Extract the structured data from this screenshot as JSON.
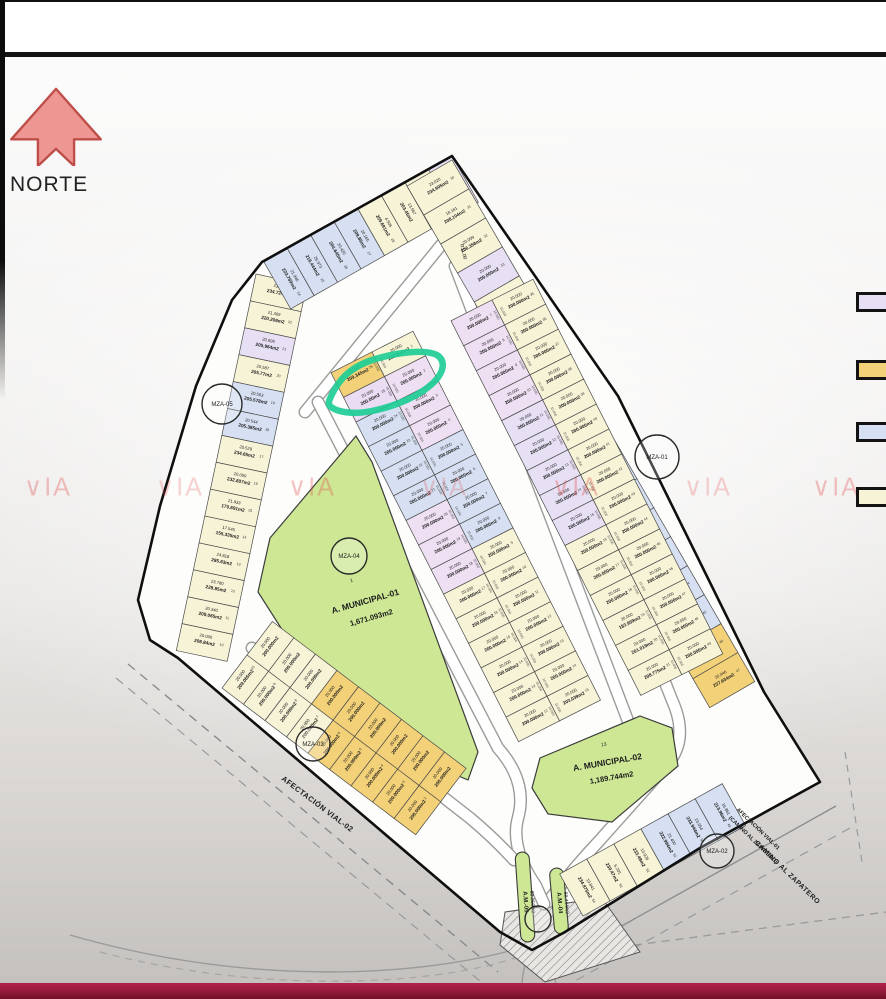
{
  "north": {
    "label": "NORTE"
  },
  "watermark": {
    "text": "VIA",
    "color": "#de4a4a"
  },
  "legend": {
    "items": [
      {
        "name": "lavender-lot",
        "color": "#e7dff3"
      },
      {
        "name": "gold-lot",
        "color": "#f3d178"
      },
      {
        "name": "blue-lot",
        "color": "#d6e0f2"
      },
      {
        "name": "cream-lot",
        "color": "#f6f3d6"
      }
    ]
  },
  "highlight": {
    "lot_number": "25",
    "area_label": "200.00m2",
    "color": "#1ecd96"
  },
  "palette": {
    "C": "#f6f3d6",
    "B": "#d6e0f2",
    "L": "#e7dff3",
    "P": "#eedff2",
    "O": "#f3d178",
    "H": "#eadcf2",
    "G": "#cde795"
  },
  "municipal": [
    {
      "num": "1",
      "name": "A. MUNICIPAL-01",
      "area": "1,671.093m2"
    },
    {
      "num": "13",
      "name": "A. MUNICIPAL-02",
      "area": "1,189.744m2"
    }
  ],
  "green_strips": [
    {
      "name": "A.M.-05",
      "area": "80.058m2"
    },
    {
      "name": "A.M.-04",
      "area": "60.444m2"
    }
  ],
  "mza_circles": [
    "MZA-01",
    "MZA-02",
    "MZA-03",
    "MZA-04",
    "MZA-05"
  ],
  "roads": {
    "vial02": "AFECTACIÓN VIAL-02",
    "vial01_line1": "AFECTACIÓN VIAL-01",
    "vial01_line2": "(CAMINO AL ZAPATERO)",
    "camino": "CAMINO AL ZAPATERO",
    "radius": "R11.00"
  },
  "strips": {
    "leftPerimeter": {
      "labels": [
        "234.724m2",
        "220.208m2",
        "205.964m2",
        "205.77m2",
        "205.578m2",
        "205.385m2",
        "234.65m2",
        "232.607m2",
        "170.691m2",
        "155.335m2",
        "285.63m2",
        "228.85m2",
        "209.065m2",
        "208.84m2"
      ],
      "dims": [
        "21.306",
        "21.309",
        "20.006",
        "20.587",
        "20.563",
        "20.544",
        "20.529",
        "20.000",
        "21.933",
        "17.545",
        "24.818",
        "23.780",
        "20.340",
        "20.000"
      ],
      "colors": [
        "C",
        "C",
        "L",
        "C",
        "B",
        "B",
        "C",
        "C",
        "C",
        "C",
        "C",
        "C",
        "C",
        "C"
      ],
      "numbers": [
        "23",
        "22",
        "21",
        "20",
        "19",
        "18",
        "17",
        "16",
        "15",
        "14",
        "13",
        "12",
        "11",
        "10"
      ]
    },
    "topPerimeter": {
      "labels": [
        "223.769m2",
        "216.444m2",
        "204.645m2",
        "209.85m2",
        "209.691m2",
        "203.45m2",
        "221.298m2",
        "208.35m2"
      ],
      "dims": [
        "21.946",
        "26.973",
        "20.420",
        "20.165",
        "4.506",
        "13.567",
        "27.033",
        "18.450"
      ],
      "colors": [
        "B",
        "B",
        "B",
        "B",
        "C",
        "C",
        "C",
        "L"
      ],
      "numbers": [
        "24",
        "25",
        "26",
        "27",
        "28",
        "",
        "",
        "29"
      ]
    },
    "rightPerimeter": {
      "labels": [
        "234.905m2",
        "208.104m2",
        "206.358m2",
        "209.000m2",
        "200.000m2",
        "200.000m2",
        "200.000m2",
        "200.000m2",
        "200.000m2",
        "200.000m2",
        "200.000m2",
        "200.000m2",
        "200.000m2",
        "200.690m2",
        "200.000m2",
        "222.712m2",
        "223.581m2",
        "237.634m2"
      ],
      "dims": [
        "23.020",
        "18.181",
        "20.009",
        "20.000",
        "20.000",
        "20.000",
        "20.000",
        "20.000",
        "20.000",
        "20.000",
        "20.000",
        "20.000",
        "20.000",
        "20.000",
        "20.500",
        "20.500",
        "20.372",
        "20.046"
      ],
      "colors": [
        "C",
        "C",
        "C",
        "L",
        "C",
        "C",
        "C",
        "C",
        "B",
        "B",
        "B",
        "B",
        "B",
        "B",
        "B",
        "B",
        "O",
        "O"
      ],
      "numbers": [
        "30",
        "31",
        "32",
        "33",
        "34",
        "35",
        "36",
        "37",
        "38",
        "39",
        "40",
        "41",
        "42",
        "43",
        "44",
        "45",
        "46",
        "47"
      ]
    },
    "leftBlockWest": {
      "dim": "20.000",
      "side": "10.000",
      "labels": [
        "209.345m2",
        "200.00m2",
        "200.000m2",
        "200.000m2",
        "200.000m2",
        "200.000m2",
        "200.000m2",
        "200.000m2",
        "200.000m2",
        "200.000m2",
        "200.000m2",
        "200.000m2",
        "200.000m2",
        "200.000m2",
        "200.000m2"
      ],
      "colors": [
        "O",
        "H",
        "B",
        "B",
        "B",
        "B",
        "P",
        "P",
        "P",
        "C",
        "C",
        "C",
        "C",
        "C",
        "C"
      ],
      "numbers": [
        "26",
        "25",
        "24",
        "23",
        "22",
        "21",
        "20",
        "19",
        "18",
        "17",
        "16",
        "15",
        "14",
        "13",
        "12"
      ]
    },
    "leftBlockEast": {
      "dim": "20.000",
      "side": "10.000",
      "labels": [
        "200.000m2",
        "200.000m2",
        "200.000m2",
        "200.000m2",
        "200.000m2",
        "200.000m2",
        "200.000m2",
        "200.000m2",
        "200.000m2",
        "200.000m2",
        "200.000m2",
        "200.000m2",
        "200.000m2",
        "200.000m2",
        "203.039m2"
      ],
      "colors": [
        "C",
        "P",
        "P",
        "P",
        "B",
        "B",
        "B",
        "B",
        "C",
        "C",
        "C",
        "C",
        "C",
        "C",
        "C"
      ],
      "numbers": [
        "1",
        "2",
        "3",
        "4",
        "5",
        "6",
        "7",
        "8",
        "9",
        "10",
        "11",
        "12",
        "13",
        "14",
        "15"
      ]
    },
    "rightBlockWest": {
      "dim": "20.000",
      "side": "10.000",
      "labels": [
        "200.000m2",
        "200.000m2",
        "200.000m2",
        "200.000m2",
        "200.000m2",
        "200.000m2",
        "200.000m2",
        "200.000m2",
        "200.000m2",
        "200.000m2",
        "200.000m2",
        "200.000m2",
        "183.959m2",
        "201.019m2",
        "208.775m2"
      ],
      "colors": [
        "P",
        "P",
        "P",
        "P",
        "L",
        "L",
        "L",
        "L",
        "L",
        "C",
        "C",
        "C",
        "C",
        "C",
        "C"
      ],
      "numbers": [
        "7",
        "8",
        "9",
        "10",
        "11",
        "12",
        "13",
        "14",
        "15",
        "16",
        "17",
        "18",
        "19",
        "20",
        "21"
      ]
    },
    "rightBlockEast": {
      "dim": "20.000",
      "side": "10.000",
      "labels": [
        "200.000m2",
        "200.000m2",
        "200.000m2",
        "200.000m2",
        "200.000m2",
        "200.000m2",
        "200.000m2",
        "200.000m2",
        "200.000m2",
        "200.000m2",
        "200.000m2",
        "200.000m2",
        "200.000m2",
        "200.000m2",
        "200.000m2"
      ],
      "colors": [
        "C",
        "C",
        "C",
        "C",
        "C",
        "C",
        "C",
        "C",
        "C",
        "C",
        "C",
        "C",
        "C",
        "C",
        "C"
      ],
      "numbers": [
        "35",
        "36",
        "37",
        "38",
        "39",
        "40",
        "41",
        "42",
        "43",
        "44",
        "45",
        "46",
        "47",
        "48",
        "49"
      ]
    },
    "bottomLeftOuter": {
      "dim": "20.000",
      "labels": [
        "209.065m2",
        "200.000m2",
        "200.000m2",
        "200.000m2",
        "200.000m2",
        "200.000m2",
        "200.000m2",
        "200.000m2",
        "200.000m2"
      ],
      "colors": [
        "C",
        "C",
        "C",
        "C",
        "O",
        "O",
        "O",
        "O",
        "O"
      ],
      "numbers": [
        "10",
        "9",
        "8",
        "7",
        "6",
        "5",
        "4",
        "3",
        "2"
      ]
    },
    "bottomLeftInner": {
      "dim": "20.000",
      "labels": [
        "200.000m2",
        "200.000m2",
        "200.000m2",
        "200.000m2",
        "200.000m2",
        "200.000m2",
        "200.000m2",
        "200.000m2",
        "200.000m2"
      ],
      "colors": [
        "C",
        "C",
        "C",
        "O",
        "O",
        "O",
        "O",
        "O",
        "O"
      ],
      "numbers": [
        "",
        "",
        "",
        "",
        "",
        "",
        "",
        "",
        ""
      ]
    },
    "bottomRight": {
      "labels": [
        "234.875m2",
        "230.47m2",
        "233.48m2",
        "222.994m2",
        "233.944m2",
        "213.96m2"
      ],
      "dims": [
        "10.841",
        "6.201",
        "13.928",
        "21.400",
        "23.954",
        "16.861"
      ],
      "colors": [
        "C",
        "C",
        "C",
        "B",
        "B",
        "B"
      ],
      "numbers": [
        "54",
        "53",
        "52",
        "51",
        "50",
        "49"
      ]
    }
  }
}
